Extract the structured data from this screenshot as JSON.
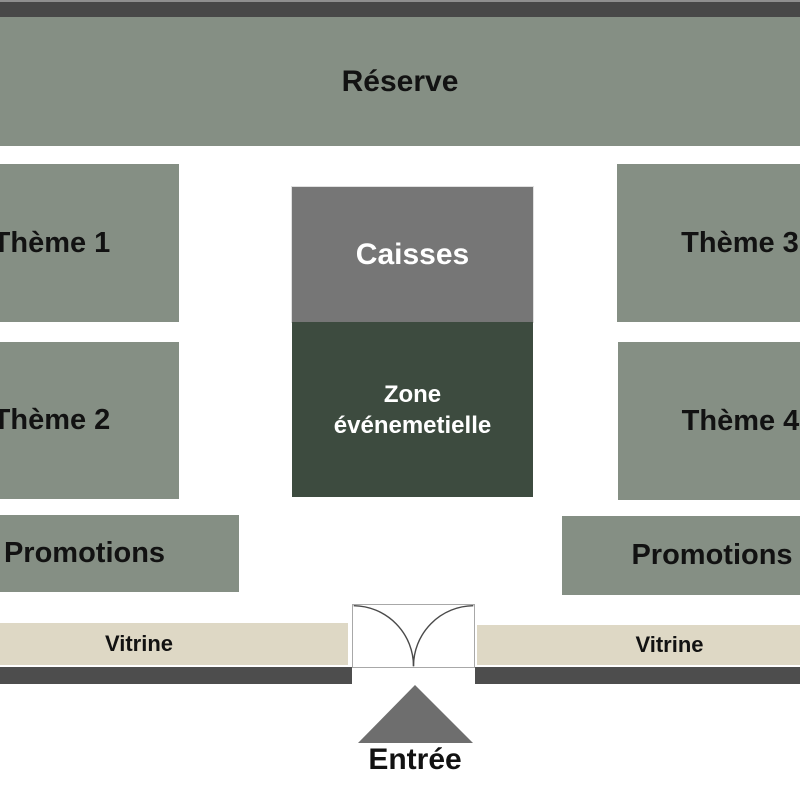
{
  "zones": {
    "reserve": "Réserve",
    "theme1": "Thème 1",
    "theme2": "Thème 2",
    "theme3": "Thème 3",
    "theme4": "Thème 4",
    "caisses": "Caisses",
    "event_line1": "Zone",
    "event_line2": "événemetielle",
    "promotions_left": "Promotions",
    "promotions_right": "Promotions",
    "vitrine_left": "Vitrine",
    "vitrine_right": "Vitrine",
    "entree": "Entrée"
  },
  "colors": {
    "department_fill": "#858F84",
    "caisses_fill": "#767676",
    "event_fill": "#3D4B3F",
    "vitrine_fill": "#DED8C5",
    "front_wall": "#4D4D4D",
    "back_wall": "#484848",
    "entrance_arrow": "#6E6E6E",
    "label_dark": "#121212",
    "label_light": "#FFFFFF"
  }
}
